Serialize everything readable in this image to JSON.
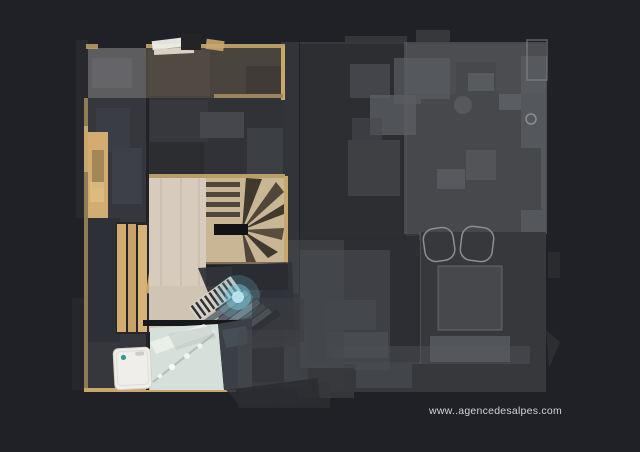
{
  "watermark": {
    "text": "www..agencedesalpes.com"
  },
  "palette": {
    "background": "#1f2126",
    "ghost-base": "#36383c",
    "ghost-dark": "#2c2e32",
    "ghost-mid": "#46484c",
    "ghost-light": "#5a5d61",
    "ghost-outline": "#8b8e92",
    "slate-floor": "#35373d",
    "balcony-gray": "#5d5d60",
    "balcony-brown": "#4a443e",
    "wood-trim": "#c9a76b",
    "wood-plank": "#d3ac71",
    "light-wood": "#d6cbbc",
    "spiral-wood": "#c9b695",
    "bathroom-floor": "#d4e0d9",
    "appliance-white": "#efeeea",
    "teal-accent": "#2a9d8f",
    "cyan-glow": "#74c6db",
    "wall-dark": "#17181b",
    "watermark-color": "#d4d4d7"
  },
  "scene": {
    "type": "3d-scan-floorplan-top-view",
    "active_section": "left wing: balcony corridor, wooden bench, spiral staircase, lower staircase, bathroom",
    "dimmed_section": "right wing: ghosted upper rooms with furniture",
    "glow": "cyan scan highlight on lower staircase"
  }
}
